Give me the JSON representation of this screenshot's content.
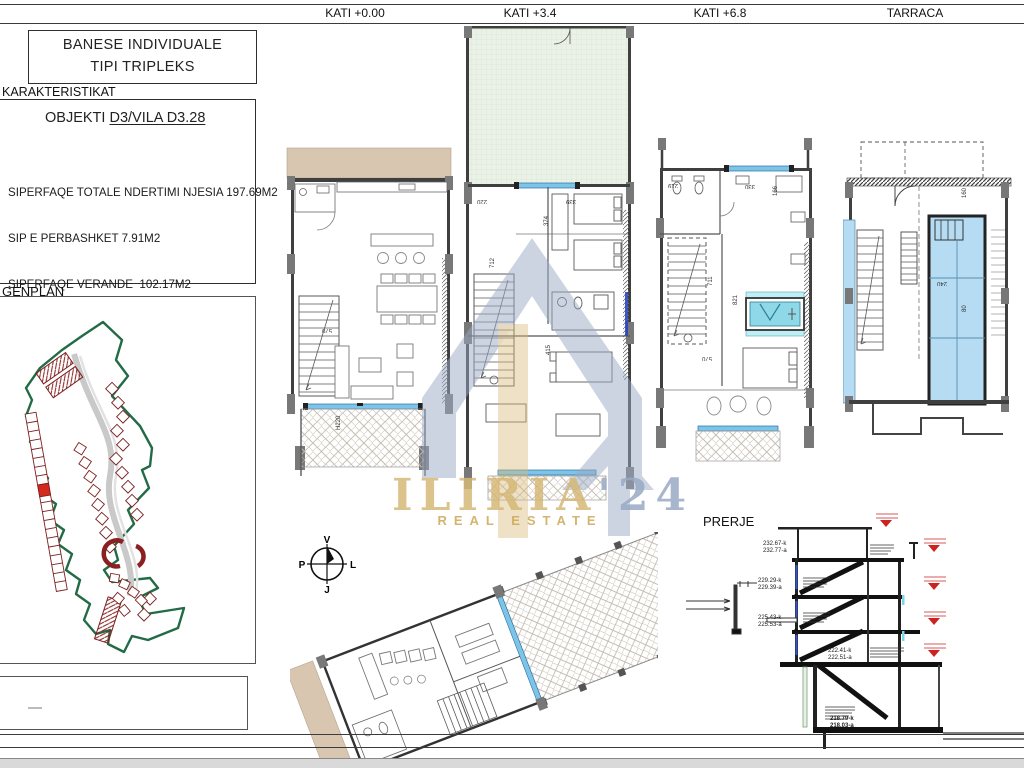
{
  "header": {
    "levels": [
      "KATI +0.00",
      "KATI +3.4",
      "KATI +6.8",
      "TARRACA"
    ]
  },
  "title_block": {
    "line1": "BANESE INDIVIDUALE",
    "line2": "TIPI TRIPLEKS"
  },
  "characteristics": {
    "heading": "KARAKTERISTIKAT",
    "object_label": "OBJEKTI",
    "object_value": "D3/VILA D3.28",
    "items": [
      "SIPERFAQE TOTALE NDERTIMI NJESIA 197.69M2",
      "SIP E PERBASHKET 7.91M2",
      "SIPERFAQE VERANDE  102.17M2",
      "SIPERFAQE PISHINE 31M2",
      "AMBJENT TEKNIK 7M2",
      "VERANDE TEKNIKE 32.3M2"
    ]
  },
  "genplan": {
    "label": "GENPLAN"
  },
  "prerje": {
    "label": "PRERJE"
  },
  "compass": {
    "north": "V",
    "south": "J",
    "east": "L",
    "west": "P"
  },
  "watermark": {
    "brand": "ILIRIA",
    "suffix": "'24",
    "tagline": "REAL ESTATE"
  },
  "section": {
    "elevations": [
      {
        "k": "232.67-k",
        "a": "232.77-a"
      },
      {
        "k": "229.29-k",
        "a": "229.39-a"
      },
      {
        "k": "225.43-k",
        "a": "225.53-a"
      },
      {
        "k": "222.41-k",
        "a": "222.51-a"
      },
      {
        "k": "218.79-k",
        "a": "218.03-a"
      }
    ]
  },
  "plans": {
    "kati0": {
      "dims": [
        "570",
        "H220"
      ]
    },
    "kati34": {
      "dims": [
        "712",
        "374",
        "339",
        "220",
        "415"
      ]
    },
    "kati68": {
      "dims": [
        "219",
        "330",
        "166",
        "711",
        "821",
        "570"
      ]
    },
    "tarraca": {
      "dims": [
        "160",
        "240",
        "80"
      ]
    },
    "colors": {
      "glass": "#7cc4e8",
      "pool": "#b5dcf3",
      "tub": "#8fd8e8",
      "terrace_tan": "#d8c6b0",
      "garden_green": "#eaf1e6",
      "site_boundary": "#226b46",
      "site_plot": "#7c2020",
      "highlight_plot": "#d42a1e",
      "marker_red": "#cc2222",
      "watermark_blue": "#9aaac5",
      "watermark_gold": "#d6b877"
    }
  }
}
